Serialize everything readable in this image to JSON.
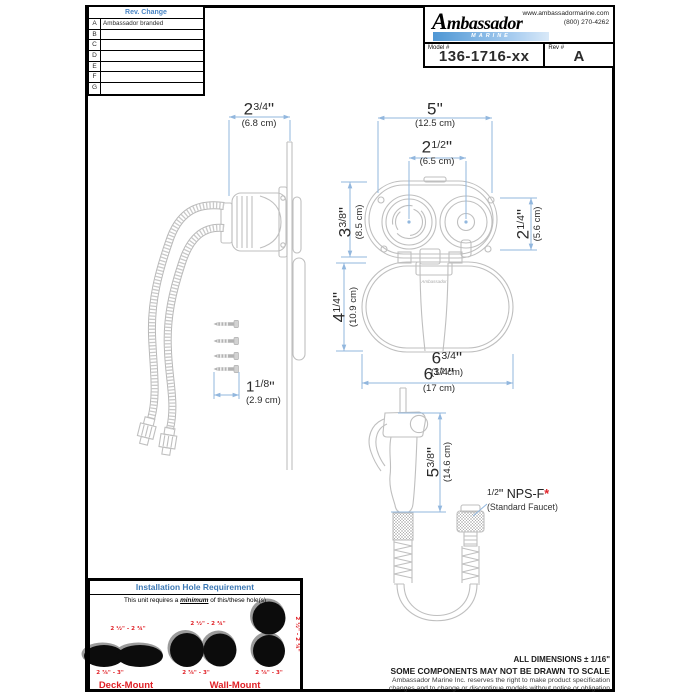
{
  "sheet": {
    "rev_table": {
      "title": "Rev. Change",
      "rows": [
        {
          "rev": "A",
          "change": "Ambassador branded"
        },
        {
          "rev": "B",
          "change": ""
        },
        {
          "rev": "C",
          "change": ""
        },
        {
          "rev": "D",
          "change": ""
        },
        {
          "rev": "E",
          "change": ""
        },
        {
          "rev": "F",
          "change": ""
        },
        {
          "rev": "G",
          "change": ""
        }
      ]
    },
    "title_block": {
      "brand": "Ambassador",
      "brand_sub": "MARINE",
      "website": "www.ambassadormarine.com",
      "phone": "(800) 270-4262",
      "model_label": "Model #",
      "model_value": "136-1716-xx",
      "rev_label": "Rev #",
      "rev_value": "A"
    }
  },
  "dims": {
    "unit": "\"",
    "side_depth": {
      "whole": "2",
      "frac": "3/4",
      "cm": "(6.8 cm)"
    },
    "overall_width": {
      "whole": "5",
      "frac": "",
      "cm": "(12.5 cm)"
    },
    "hole_spacing": {
      "whole": "2",
      "frac": "1/2",
      "cm": "(6.5 cm)"
    },
    "lid_height": {
      "whole": "3",
      "frac": "3/8",
      "cm": "(8.5 cm)"
    },
    "opening_height": {
      "whole": "2",
      "frac": "1/4",
      "cm": "(5.6 cm)"
    },
    "cup_height": {
      "whole": "4",
      "frac": "1/4",
      "cm": "(10.9 cm)"
    },
    "base_width": {
      "whole": "6",
      "frac": "3/4",
      "cm": "(17 cm)"
    },
    "screw_length": {
      "whole": "1",
      "frac": "1/8",
      "cm": "(2.9 cm)"
    },
    "sprayer_height": {
      "whole": "5",
      "frac": "3/8",
      "cm": "(14.6 cm)"
    }
  },
  "callouts": {
    "faucet_thread": {
      "frac": "1/2",
      "unit": "\"",
      "label": " NPS-F",
      "asterisk": "*",
      "sub": "(Standard Faucet)"
    },
    "strap_logo": "Ambassador"
  },
  "install_box": {
    "title": "Installation Hole Requirement",
    "subtitle_pre": "This unit requires a ",
    "subtitle_em": "minimum",
    "subtitle_post": " of this/these hole(s)",
    "deck": {
      "top_label": "2 ½\" - 2 ¾\"",
      "bottom_label": "2 ⅞\" - 3\"",
      "name": "Deck-Mount"
    },
    "wall": {
      "top_label": "2 ½\" - 2 ¾\"",
      "bottom_label_h": "2 ⅞\" - 3\"",
      "side_label": "2 ½\" - 2 ¾\"",
      "bottom_label_v": "2 ⅞\" - 3\"",
      "name": "Wall-Mount"
    }
  },
  "footer": {
    "note1": "ALL DIMENSIONS ± 1/16\"",
    "note2": "SOME COMPONENTS MAY NOT BE DRAWN TO SCALE",
    "disclaimer1": "Ambassador Marine Inc. reserves the right to make product specification",
    "disclaimer2": "changes and to change or discontinue models without notice or obligation"
  },
  "colors": {
    "dim_line": "#92b7de",
    "drawing_line": "#bfbfbf",
    "accent_red": "#e02127",
    "table_header_blue": "#4b86c5",
    "install_title_blue": "#3c78b4",
    "logo_bar_blue": "#549bd5"
  }
}
